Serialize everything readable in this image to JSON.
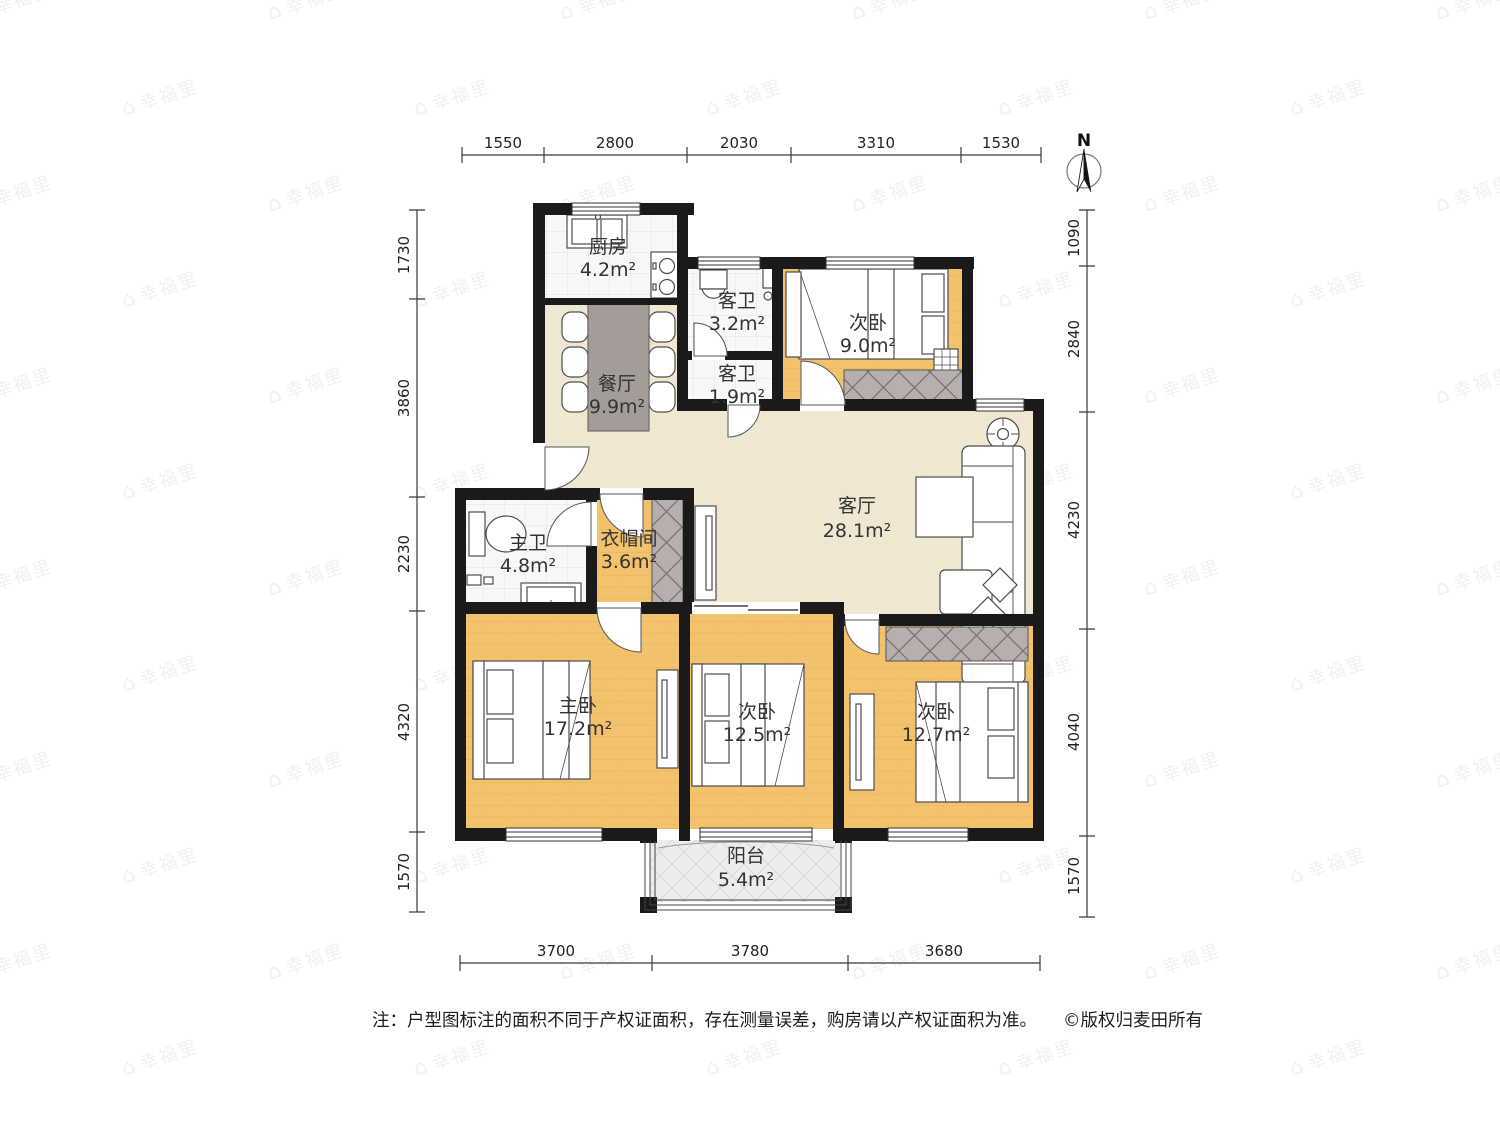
{
  "watermark": {
    "text": "幸福里",
    "icon": "house-icon",
    "icon_char": "⌂"
  },
  "north": {
    "label": "N"
  },
  "dimensions": {
    "top": [
      "1550",
      "2800",
      "2030",
      "3310",
      "1530"
    ],
    "bottom": [
      "3700",
      "3780",
      "3680"
    ],
    "left": [
      "1730",
      "3860",
      "2230",
      "4320",
      "1570"
    ],
    "right": [
      "1090",
      "2840",
      "4230",
      "4040",
      "1570"
    ]
  },
  "rooms": {
    "kitchen": {
      "name": "厨房",
      "area": "4.2m²"
    },
    "guest_bath_big": {
      "name": "客卫",
      "area": "3.2m²"
    },
    "bedroom_top": {
      "name": "次卧",
      "area": "9.0m²"
    },
    "dining": {
      "name": "餐厅",
      "area": "9.9m²"
    },
    "guest_bath_small": {
      "name": "客卫",
      "area": "1.9m²"
    },
    "living": {
      "name": "客厅",
      "area": "28.1m²"
    },
    "master_bath": {
      "name": "主卫",
      "area": "4.8m²"
    },
    "closet": {
      "name": "衣帽间",
      "area": "3.6m²"
    },
    "master_bedroom": {
      "name": "主卧",
      "area": "17.2m²"
    },
    "bedroom_mid": {
      "name": "次卧",
      "area": "12.5m²"
    },
    "bedroom_right": {
      "name": "次卧",
      "area": "12.7m²"
    },
    "balcony": {
      "name": "阳台",
      "area": "5.4m²"
    }
  },
  "footer": {
    "note": "注：户型图标注的面积不同于产权证面积，存在测量误差，购房请以产权证面积为准。",
    "copyright": "©版权归麦田所有"
  },
  "colors": {
    "wall": "#1a1a1a",
    "public_floor": "#f0e7d2",
    "bedroom_floor": "#f2c26d",
    "tile_floor": "#f8f8f8",
    "balcony_floor": "#ededed",
    "wardrobe": "#b6afae",
    "dining_table": "#a39c99",
    "label_text": "#333333"
  }
}
